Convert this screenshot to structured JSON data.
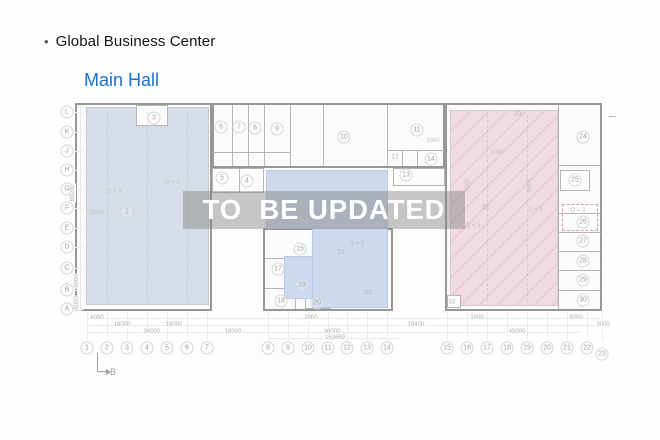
{
  "header": {
    "bullet": "•",
    "title": "Global Business Center"
  },
  "subtitle": {
    "text": "Main Hall"
  },
  "watermark": {
    "text": "TO  BE UPDATED"
  },
  "colors": {
    "accent_blue": "#1a70d6",
    "hall_zone": "#d6dde6",
    "annex_zone": "#ccd9ee",
    "parking_zone": "#f0dbe3",
    "watermark_band": "rgba(128,128,128,0.45)",
    "watermark_text": "#fefefe"
  },
  "floorplan": {
    "grid_rows": [
      {
        "l": "L",
        "y": 112
      },
      {
        "l": "K",
        "y": 132
      },
      {
        "l": "J",
        "y": 151
      },
      {
        "l": "H",
        "y": 170
      },
      {
        "l": "G",
        "y": 189
      },
      {
        "l": "F",
        "y": 208
      },
      {
        "l": "E",
        "y": 228
      },
      {
        "l": "D",
        "y": 247
      },
      {
        "l": "C",
        "y": 268
      },
      {
        "l": "B",
        "y": 290
      },
      {
        "l": "A",
        "y": 309
      }
    ],
    "grid_cols": [
      {
        "n": "1",
        "x": 87,
        "y": 348
      },
      {
        "n": "2",
        "x": 107,
        "y": 348
      },
      {
        "n": "3",
        "x": 127,
        "y": 348
      },
      {
        "n": "4",
        "x": 147,
        "y": 348
      },
      {
        "n": "5",
        "x": 167,
        "y": 348
      },
      {
        "n": "6",
        "x": 187,
        "y": 348
      },
      {
        "n": "7",
        "x": 207,
        "y": 348
      },
      {
        "n": "8",
        "x": 268,
        "y": 348
      },
      {
        "n": "9",
        "x": 288,
        "y": 348
      },
      {
        "n": "10",
        "x": 308,
        "y": 348
      },
      {
        "n": "11",
        "x": 328,
        "y": 348
      },
      {
        "n": "12",
        "x": 347,
        "y": 348
      },
      {
        "n": "13",
        "x": 367,
        "y": 348
      },
      {
        "n": "14",
        "x": 387,
        "y": 348
      },
      {
        "n": "15",
        "x": 447,
        "y": 348
      },
      {
        "n": "16",
        "x": 467,
        "y": 348
      },
      {
        "n": "17",
        "x": 487,
        "y": 348
      },
      {
        "n": "18",
        "x": 507,
        "y": 348
      },
      {
        "n": "19",
        "x": 527,
        "y": 348
      },
      {
        "n": "20",
        "x": 547,
        "y": 348
      },
      {
        "n": "21",
        "x": 567,
        "y": 348
      },
      {
        "n": "22",
        "x": 587,
        "y": 348
      },
      {
        "n": "23",
        "x": 602,
        "y": 354
      }
    ],
    "rooms": [
      {
        "n": "2",
        "x": 127,
        "y": 212,
        "c": true
      },
      {
        "n": "3",
        "x": 154,
        "y": 118,
        "c": true
      },
      {
        "n": "6",
        "x": 221,
        "y": 127,
        "c": true
      },
      {
        "n": "7",
        "x": 239,
        "y": 127,
        "c": true
      },
      {
        "n": "8",
        "x": 255,
        "y": 128,
        "c": true
      },
      {
        "n": "9",
        "x": 277,
        "y": 129,
        "c": true
      },
      {
        "n": "5",
        "x": 222,
        "y": 178,
        "c": true
      },
      {
        "n": "4",
        "x": 247,
        "y": 181,
        "c": true
      },
      {
        "n": "10",
        "x": 344,
        "y": 137,
        "c": true
      },
      {
        "n": "11",
        "x": 417,
        "y": 130,
        "c": true
      },
      {
        "n": "12",
        "x": 395,
        "y": 157,
        "c": false
      },
      {
        "n": "13",
        "x": 406,
        "y": 175,
        "c": true
      },
      {
        "n": "14",
        "x": 431,
        "y": 159,
        "c": true
      },
      {
        "n": "15",
        "x": 300,
        "y": 249,
        "c": true
      },
      {
        "n": "17",
        "x": 278,
        "y": 269,
        "c": true
      },
      {
        "n": "18",
        "x": 281,
        "y": 301,
        "c": true
      },
      {
        "n": "19",
        "x": 302,
        "y": 285,
        "c": true
      },
      {
        "n": "20",
        "x": 317,
        "y": 303,
        "c": true
      },
      {
        "n": "21",
        "x": 341,
        "y": 252,
        "c": false
      },
      {
        "n": "22",
        "x": 368,
        "y": 292,
        "c": false
      },
      {
        "n": "23",
        "x": 518,
        "y": 114,
        "c": false
      },
      {
        "n": "24",
        "x": 583,
        "y": 137,
        "c": true
      },
      {
        "n": "25",
        "x": 575,
        "y": 180,
        "c": true
      },
      {
        "n": "26",
        "x": 583,
        "y": 222,
        "c": true
      },
      {
        "n": "27",
        "x": 583,
        "y": 241,
        "c": true
      },
      {
        "n": "28",
        "x": 583,
        "y": 261,
        "c": true
      },
      {
        "n": "29",
        "x": 583,
        "y": 280,
        "c": true
      },
      {
        "n": "30",
        "x": 583,
        "y": 300,
        "c": true
      },
      {
        "n": "31",
        "x": 486,
        "y": 207,
        "c": false
      },
      {
        "n": "32",
        "x": 452,
        "y": 302,
        "c": false
      }
    ],
    "bottom_dims": [
      {
        "t": "6000",
        "x": 97,
        "y": 318
      },
      {
        "t": "18000",
        "x": 122,
        "y": 325
      },
      {
        "t": "18000",
        "x": 174,
        "y": 325
      },
      {
        "t": "36000",
        "x": 152,
        "y": 332
      },
      {
        "t": "18000",
        "x": 233,
        "y": 332
      },
      {
        "t": "2000",
        "x": 311,
        "y": 318
      },
      {
        "t": "36000",
        "x": 332,
        "y": 332
      },
      {
        "t": "153669",
        "x": 335,
        "y": 338
      },
      {
        "t": "18400",
        "x": 416,
        "y": 325
      },
      {
        "t": "1000",
        "x": 477,
        "y": 318
      },
      {
        "t": "45000",
        "x": 517,
        "y": 332
      },
      {
        "t": "6000",
        "x": 576,
        "y": 318
      },
      {
        "t": "3000",
        "x": 603,
        "y": 325
      }
    ],
    "left_dims": [
      {
        "t": "60000",
        "x": 73,
        "y": 193
      },
      {
        "t": "6000",
        "x": 77,
        "y": 281
      },
      {
        "t": "6000",
        "x": 77,
        "y": 303
      }
    ],
    "annotations": [
      {
        "t": "G + 3",
        "x": 114,
        "y": 192
      },
      {
        "t": "G + 3",
        "x": 172,
        "y": 183
      },
      {
        "t": "2000",
        "x": 97,
        "y": 213
      },
      {
        "t": "Q = 3",
        "x": 357,
        "y": 244
      },
      {
        "t": "Q = 3",
        "x": 535,
        "y": 210
      },
      {
        "t": "Q = 3",
        "x": 473,
        "y": 226
      },
      {
        "t": "Q = 3",
        "x": 578,
        "y": 211
      },
      {
        "t": "1000",
        "x": 433,
        "y": 141
      },
      {
        "t": "1000",
        "x": 497,
        "y": 153
      },
      {
        "t": "6000",
        "x": 468,
        "y": 185,
        "rot": true
      },
      {
        "t": "6000",
        "x": 530,
        "y": 185,
        "rot": true
      }
    ],
    "section_marker": {
      "label": "B"
    }
  }
}
